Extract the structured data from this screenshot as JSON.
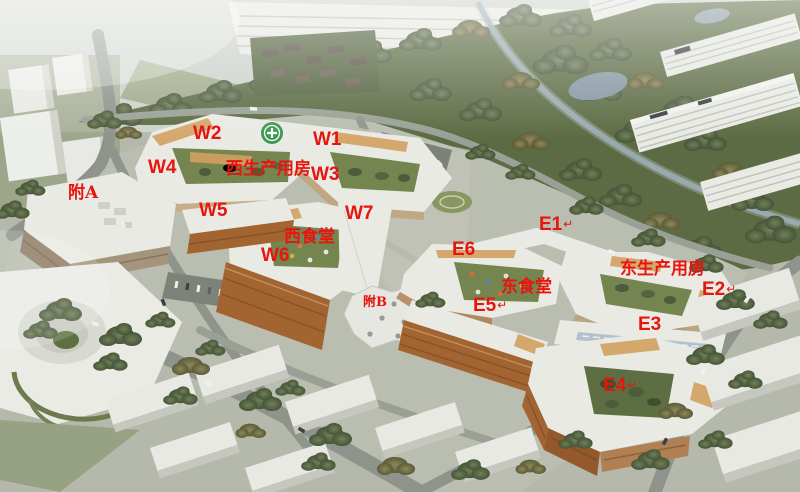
{
  "image": {
    "kind": "aerial-architectural-rendering",
    "accent_color": "#e8140e",
    "arrow_glyph": "↵"
  },
  "annotations": [
    {
      "id": "w2",
      "text": "W2",
      "x": 193,
      "y": 124,
      "style": "code"
    },
    {
      "id": "w1",
      "text": "W1",
      "x": 313,
      "y": 130,
      "style": "code"
    },
    {
      "id": "w4",
      "text": "W4",
      "x": 148,
      "y": 158,
      "style": "code"
    },
    {
      "id": "west-production-hall",
      "text": "西生产用房",
      "x": 226,
      "y": 161,
      "style": "cjk"
    },
    {
      "id": "w3",
      "text": "W3",
      "x": 311,
      "y": 165,
      "style": "code"
    },
    {
      "id": "annex-a",
      "text": "附A",
      "x": 68,
      "y": 185,
      "style": "cjk"
    },
    {
      "id": "w5",
      "text": "W5",
      "x": 199,
      "y": 201,
      "style": "code"
    },
    {
      "id": "w7",
      "text": "W7",
      "x": 345,
      "y": 204,
      "style": "code"
    },
    {
      "id": "e1",
      "text": "E1",
      "x": 539,
      "y": 215,
      "style": "code",
      "arrow": true
    },
    {
      "id": "west-canteen",
      "text": "西食堂",
      "x": 284,
      "y": 229,
      "style": "cjk"
    },
    {
      "id": "e6",
      "text": "E6",
      "x": 452,
      "y": 240,
      "style": "code"
    },
    {
      "id": "w6",
      "text": "W6",
      "x": 261,
      "y": 246,
      "style": "code"
    },
    {
      "id": "east-production-hall",
      "text": "东生产用房",
      "x": 620,
      "y": 261,
      "style": "cjk"
    },
    {
      "id": "east-canteen",
      "text": "东食堂",
      "x": 501,
      "y": 279,
      "style": "cjk"
    },
    {
      "id": "e2",
      "text": "E2",
      "x": 702,
      "y": 280,
      "style": "code",
      "arrow": true
    },
    {
      "id": "annex-b",
      "text": "附B",
      "x": 363,
      "y": 296,
      "style": "cjk-small"
    },
    {
      "id": "e5",
      "text": "E5",
      "x": 473,
      "y": 296,
      "style": "code",
      "arrow": true
    },
    {
      "id": "e3",
      "text": "E3",
      "x": 638,
      "y": 315,
      "style": "code"
    },
    {
      "id": "e4",
      "text": "E4",
      "x": 603,
      "y": 376,
      "style": "code",
      "arrow": true
    }
  ]
}
